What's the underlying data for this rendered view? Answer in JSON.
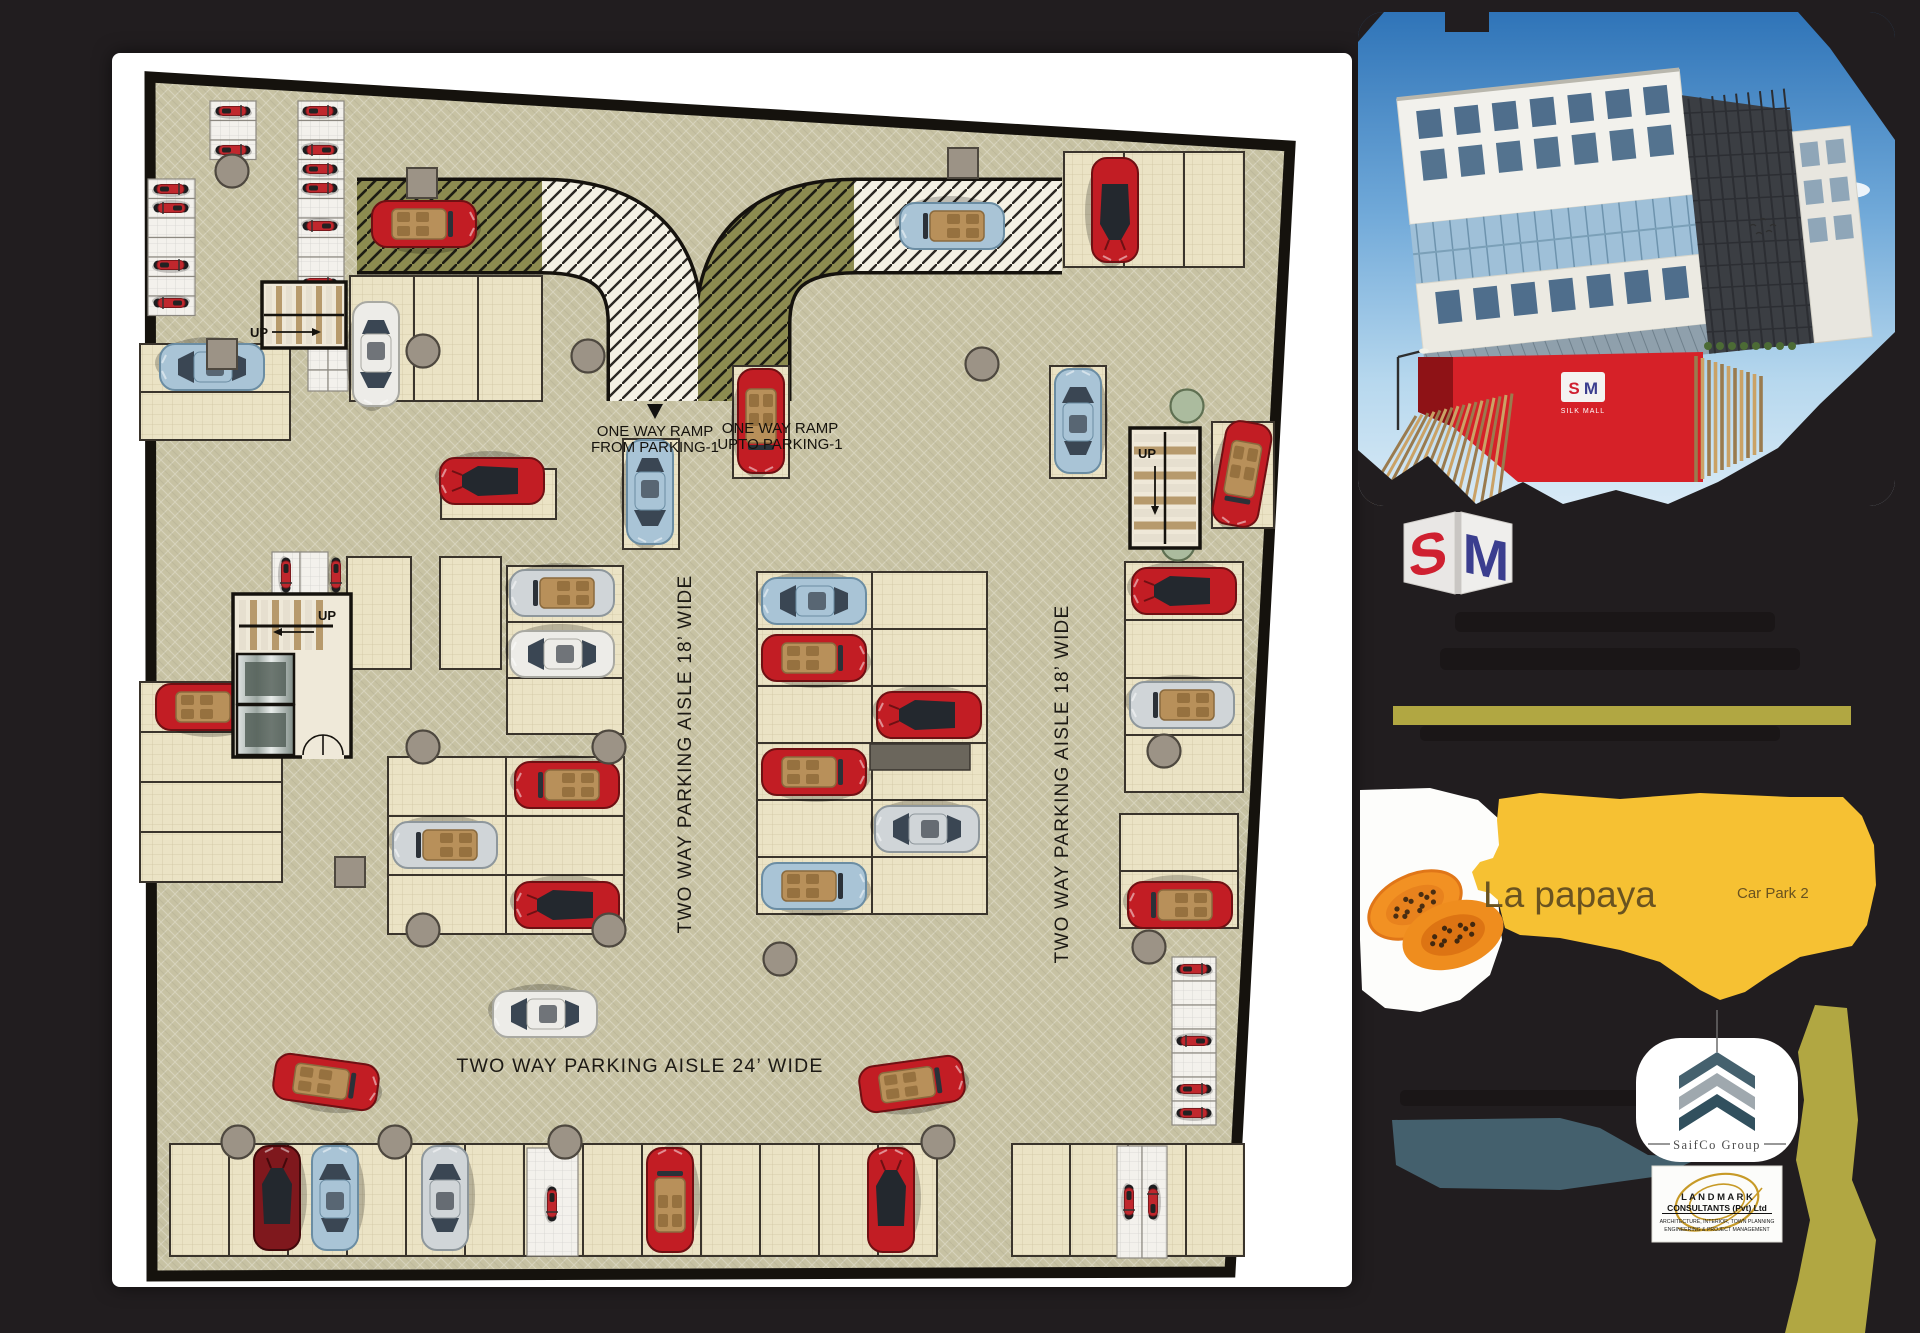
{
  "page": {
    "background": "#211d1f",
    "sheet_background": "#ffffff"
  },
  "plan": {
    "labels": {
      "up": "UP",
      "ramp_from_1": "ONE WAY RAMP",
      "ramp_from_2": "FROM PARKING-1",
      "ramp_upto_1": "ONE WAY RAMP",
      "ramp_upto_2": "UPTO PARKING-1",
      "aisle_left": "TWO WAY PARKING AISLE 18’ WIDE",
      "aisle_right": "TWO WAY PARKING AISLE 18’ WIDE",
      "aisle_bottom": "TWO WAY PARKING AISLE 24’ WIDE"
    },
    "colors": {
      "floor": "#c7c2a3",
      "stall": "#ebe3c5",
      "moto_stall": "#f3f1ec",
      "wall": "#15120d",
      "ramp_olive": "#8c8b50",
      "ramp_light": "#f4f1e4",
      "column": "#9c9386",
      "column_sage": "#abbb9e",
      "interior_tan": "#b8905a",
      "moto": "#c0272d",
      "car": {
        "red": "#c21d24",
        "silver": "#d0d5d8",
        "blue": "#a9c4d6",
        "white": "#edece8",
        "dark": "#7f181d"
      }
    },
    "stall_groups": [
      [
        58,
        1090,
        13,
        1,
        59,
        112,
        "car"
      ],
      [
        900,
        1090,
        4,
        1,
        58,
        112,
        "car"
      ],
      [
        276,
        703,
        2,
        3,
        118,
        59,
        "car"
      ],
      [
        645,
        518,
        2,
        6,
        115,
        57,
        "car"
      ],
      [
        1013,
        508,
        1,
        2,
        118,
        58,
        "car"
      ],
      [
        1013,
        624,
        1,
        2,
        118,
        57,
        "car"
      ],
      [
        1008,
        760,
        1,
        2,
        118,
        57,
        "car"
      ],
      [
        952,
        98,
        3,
        1,
        60,
        115,
        "car"
      ],
      [
        238,
        222,
        3,
        1,
        64,
        125,
        "car"
      ],
      [
        28,
        628,
        1,
        4,
        142,
        50,
        "car"
      ],
      [
        28,
        290,
        1,
        2,
        150,
        48,
        "car"
      ],
      [
        329,
        415,
        1,
        1,
        115,
        50,
        "car"
      ],
      [
        511,
        385,
        1,
        1,
        56,
        110,
        "car"
      ],
      [
        621,
        312,
        1,
        1,
        56,
        112,
        "car"
      ],
      [
        938,
        312,
        1,
        1,
        56,
        112,
        "car"
      ],
      [
        395,
        512,
        1,
        3,
        116,
        56,
        "car"
      ],
      [
        235,
        503,
        1,
        1,
        64,
        112,
        "car"
      ],
      [
        328,
        503,
        1,
        1,
        61,
        112,
        "car"
      ],
      [
        1100,
        368,
        1,
        1,
        62,
        106,
        "car"
      ],
      [
        98,
        47,
        1,
        3,
        46,
        19.5,
        "moto"
      ],
      [
        186,
        47,
        1,
        10,
        46,
        19.5,
        "moto"
      ],
      [
        36,
        125,
        1,
        7,
        47,
        19.5,
        "moto"
      ],
      [
        160,
        498,
        2,
        1,
        28,
        46,
        "moto"
      ],
      [
        196,
        295,
        2,
        2,
        20,
        21,
        "moto"
      ],
      [
        1060,
        903,
        1,
        7,
        44,
        24,
        "moto"
      ],
      [
        415,
        1094,
        1,
        1,
        51,
        108,
        "moto"
      ],
      [
        1005,
        1092,
        2,
        1,
        25,
        112,
        "moto"
      ]
    ],
    "cars": [
      [
        312,
        170,
        0,
        "conv",
        "red"
      ],
      [
        840,
        172,
        180,
        "conv",
        "blue"
      ],
      [
        1003,
        156,
        90,
        "sport",
        "red"
      ],
      [
        100,
        313,
        180,
        "sedan",
        "blue"
      ],
      [
        264,
        300,
        90,
        "sedan",
        "white"
      ],
      [
        380,
        427,
        180,
        "sport",
        "red"
      ],
      [
        538,
        438,
        90,
        "sedan",
        "blue"
      ],
      [
        649,
        367,
        90,
        "conv",
        "red"
      ],
      [
        966,
        367,
        270,
        "sedan",
        "blue"
      ],
      [
        1130,
        420,
        100,
        "conv",
        "red"
      ],
      [
        450,
        539,
        180,
        "conv",
        "silver"
      ],
      [
        450,
        600,
        180,
        "sedan",
        "white"
      ],
      [
        455,
        731,
        180,
        "conv",
        "red"
      ],
      [
        333,
        791,
        180,
        "conv",
        "silver"
      ],
      [
        455,
        851,
        180,
        "sport",
        "red"
      ],
      [
        702,
        547,
        180,
        "sedan",
        "blue"
      ],
      [
        702,
        604,
        0,
        "conv",
        "red"
      ],
      [
        817,
        661,
        180,
        "sport",
        "red"
      ],
      [
        702,
        718,
        0,
        "conv",
        "red"
      ],
      [
        815,
        775,
        180,
        "sedan",
        "silver"
      ],
      [
        702,
        832,
        0,
        "conv",
        "blue"
      ],
      [
        1072,
        537,
        180,
        "sport",
        "red"
      ],
      [
        1070,
        651,
        180,
        "conv",
        "silver"
      ],
      [
        1068,
        851,
        180,
        "conv",
        "red"
      ],
      [
        96,
        653,
        0,
        "conv",
        "red"
      ],
      [
        433,
        960,
        180,
        "sedan",
        "white"
      ],
      [
        214,
        1028,
        8,
        "conv",
        "red"
      ],
      [
        800,
        1030,
        352,
        "conv",
        "red"
      ],
      [
        165,
        1144,
        270,
        "sport",
        "dark"
      ],
      [
        223,
        1144,
        270,
        "sedan",
        "blue"
      ],
      [
        333,
        1144,
        270,
        "sedan",
        "silver"
      ],
      [
        558,
        1146,
        270,
        "conv",
        "red"
      ],
      [
        779,
        1146,
        270,
        "sport",
        "red"
      ]
    ],
    "motos": [
      [
        121,
        57,
        0
      ],
      [
        121,
        96,
        0
      ],
      [
        208,
        57,
        0
      ],
      [
        208,
        96,
        180
      ],
      [
        208,
        115,
        0
      ],
      [
        208,
        134,
        0
      ],
      [
        208,
        172,
        180
      ],
      [
        208,
        229,
        0
      ],
      [
        59,
        135,
        0
      ],
      [
        59,
        154,
        180
      ],
      [
        59,
        211,
        0
      ],
      [
        59,
        249,
        180
      ],
      [
        174,
        521,
        90
      ],
      [
        224,
        521,
        90
      ],
      [
        1082,
        915,
        0
      ],
      [
        1082,
        987,
        180
      ],
      [
        1082,
        1035,
        0
      ],
      [
        1082,
        1059,
        0
      ],
      [
        440,
        1150,
        90
      ],
      [
        1017,
        1148,
        90
      ],
      [
        1041,
        1148,
        270
      ]
    ],
    "columns": [
      [
        120,
        117,
        "round"
      ],
      [
        311,
        297,
        "round"
      ],
      [
        476,
        302,
        "round"
      ],
      [
        870,
        310,
        "round"
      ],
      [
        311,
        693,
        "round"
      ],
      [
        497,
        693,
        "round"
      ],
      [
        311,
        876,
        "round"
      ],
      [
        497,
        876,
        "round"
      ],
      [
        668,
        905,
        "round"
      ],
      [
        126,
        1088,
        "round"
      ],
      [
        283,
        1088,
        "round"
      ],
      [
        453,
        1088,
        "round"
      ],
      [
        826,
        1088,
        "round"
      ],
      [
        1052,
        697,
        "round"
      ],
      [
        1037,
        893,
        "round"
      ],
      [
        1075,
        352,
        "sage"
      ],
      [
        1066,
        490,
        "sage"
      ],
      [
        110,
        300,
        "square"
      ],
      [
        310,
        129,
        "square"
      ],
      [
        851,
        109,
        "square"
      ],
      [
        238,
        818,
        "square"
      ]
    ],
    "shaded_strips": [
      [
        758,
        690,
        100,
        26
      ]
    ]
  },
  "sidebar": {
    "building": {
      "mini_logo_s": "S",
      "mini_logo_m": "M",
      "mini_logo_label": "SILK MALL"
    },
    "sm_monogram": {
      "s": "S",
      "m": "M",
      "s_color": "#cf2030",
      "m_color": "#3b3e8f"
    },
    "banner": {
      "title": "La papaya",
      "area_label": "Car Park 2",
      "bg": "#f6c133",
      "text_color": "#6a5320"
    },
    "accents": {
      "olive": "#b1a742",
      "teal": "#44606d"
    },
    "saifco": {
      "name": "SaifCo Group"
    },
    "landmark": {
      "line1": "L A N D M A R K",
      "line2": "CONSULTANTS (Pvt) Ltd",
      "line3": "ARCHITECTURE, INTERIOR, TOWN PLANNING",
      "line4": "ENGINEERING & PROJECT MANAGEMENT",
      "gold": "#c79a27"
    }
  }
}
